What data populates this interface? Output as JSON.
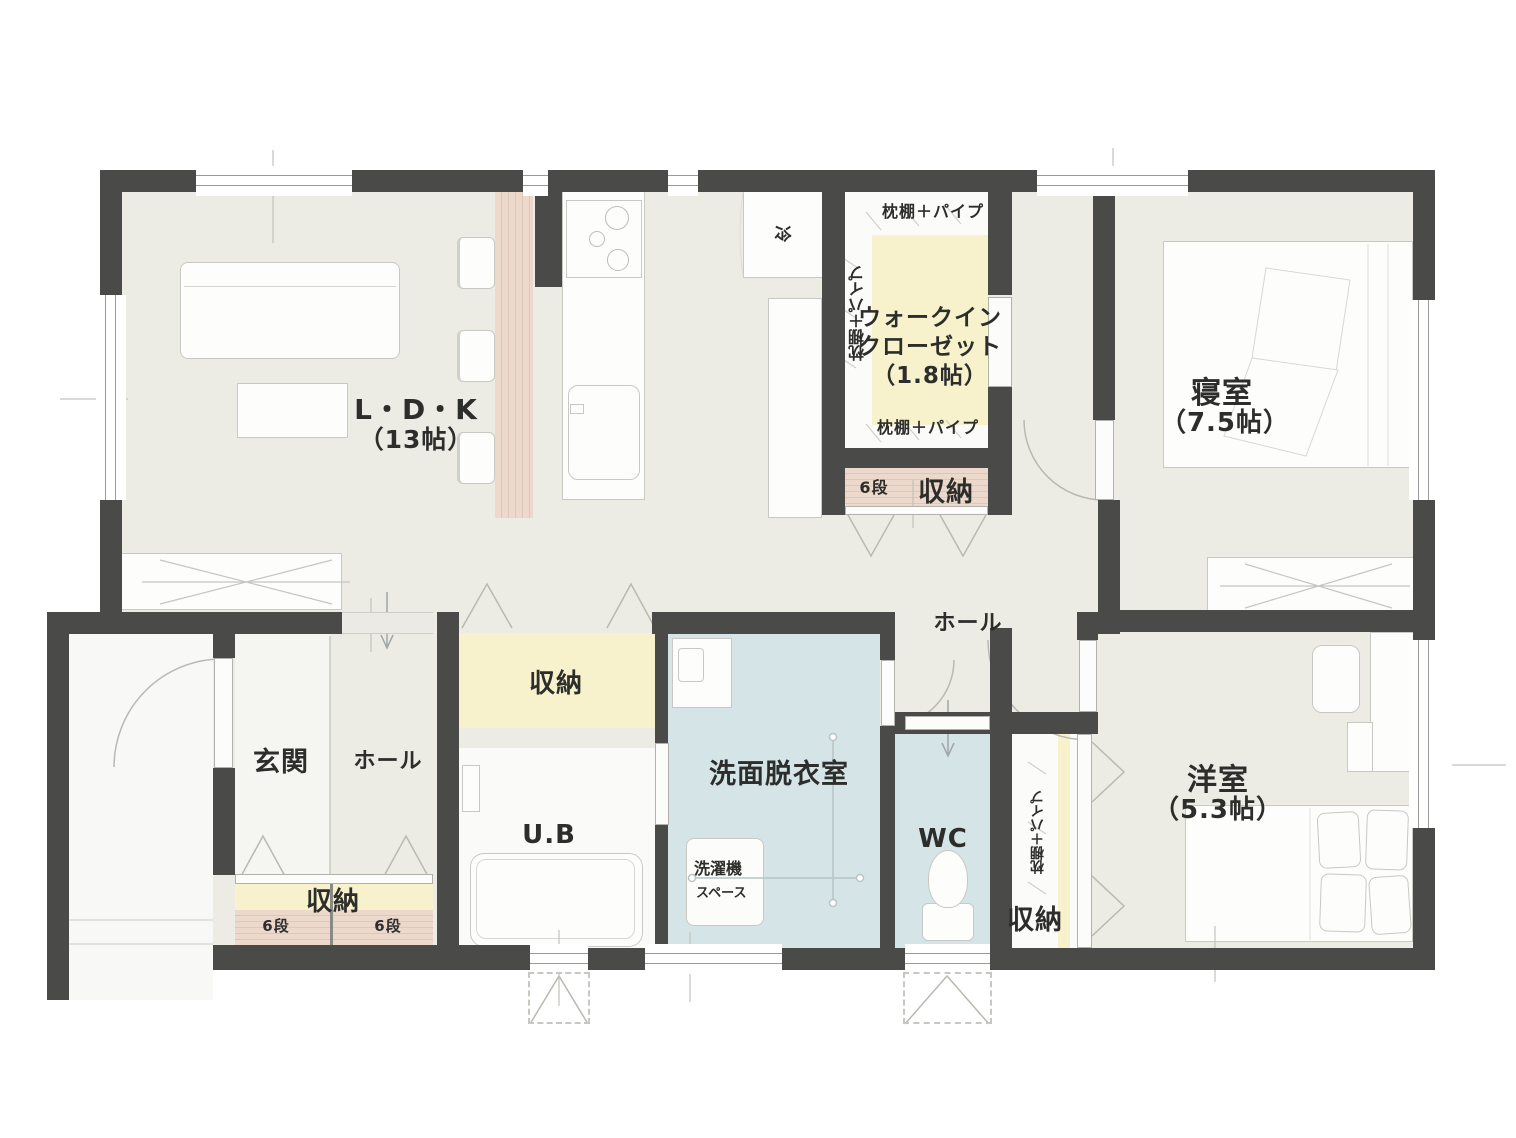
{
  "rooms": {
    "ldk": {
      "name": "L・D・K",
      "size": "（13帖）"
    },
    "bedroom": {
      "name": "寝室",
      "size": "（7.5帖）"
    },
    "western_room": {
      "name": "洋室",
      "size": "（5.3帖）"
    },
    "walk_in_closet": {
      "name_line1": "ウォークイン",
      "name_line2": "クローゼット",
      "size": "（1.8帖）",
      "shelf_top": "枕棚＋パイプ",
      "shelf_left": "枕棚＋パイプ",
      "shelf_bottom": "枕棚＋パイプ"
    },
    "entrance": {
      "name": "玄関"
    },
    "entrance_hall": {
      "name": "ホール"
    },
    "hall": {
      "name": "ホール"
    },
    "unit_bath": {
      "name": "U.B"
    },
    "washroom": {
      "name": "洗面脱衣室",
      "laundry_line1": "洗濯機",
      "laundry_line2": "スペース"
    },
    "toilet": {
      "name": "WC"
    }
  },
  "storage": {
    "entrance_storage": {
      "name": "収納",
      "left_steps": "6段",
      "right_steps": "6段"
    },
    "wic_lower_storage": {
      "name": "収納",
      "steps": "6段"
    },
    "hall_storage": {
      "name": "収納"
    },
    "western_closet": {
      "name": "収納",
      "shelf": "枕棚＋パイプ"
    }
  },
  "kitchen": {
    "fridge_label": "冷"
  },
  "colors": {
    "wall": "#4a4a49",
    "floor_beige": "#edece4",
    "wet_area_blue": "#d5e4e6",
    "storage_yellow": "#f7f2cc",
    "wood_shelf": "#ecd9cb",
    "white_floor": "#f7f7f4",
    "line_gray": "#b9b9b2"
  }
}
